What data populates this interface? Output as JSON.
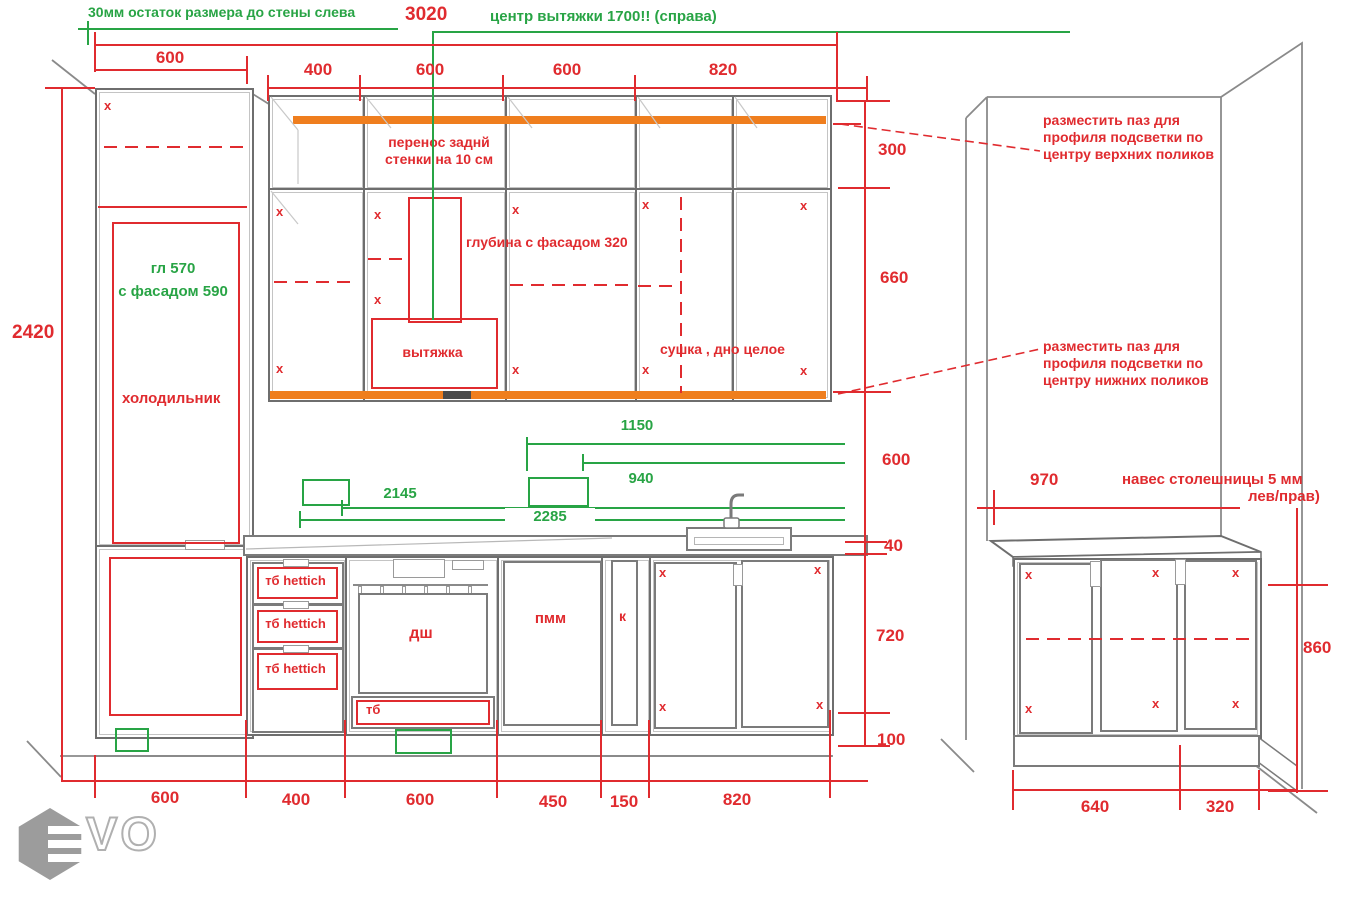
{
  "notes": {
    "left_wall_offset": "30мм остаток размера до стены слева",
    "hood_center": "центр вытяжки 1700!! (справа)",
    "back_panel": "перенос заднй стенки на 10 см",
    "depth_facade": "глубина с фасадом 320",
    "hood": "вытяжка",
    "dryer": "сушка , дно целое",
    "fridge_depth_1": "гл 570",
    "fridge_depth_2": "с фасадом 590",
    "fridge": "холодильник",
    "groove_upper": "разместить паз для профиля подсветки по центру верхних поликов",
    "groove_lower": "разместить паз для профиля подсветки по центру нижних поликов",
    "overhang_1": "навес столешницы 5 мм",
    "overhang_2": "лев/прав)"
  },
  "labels": {
    "drawer_hettich": "тб hettich",
    "drawer_tb": "тб",
    "oven": "дш",
    "dishwasher": "пмм",
    "cargo": "к",
    "x": "x"
  },
  "dims": {
    "d3020": "3020",
    "d2420": "2420",
    "d600": "600",
    "d400": "400",
    "d820": "820",
    "d300": "300",
    "d660": "660",
    "d1150": "1150",
    "d940": "940",
    "d2145": "2145",
    "d2285": "2285",
    "d40": "40",
    "d720": "720",
    "d100": "100",
    "d450": "450",
    "d150": "150",
    "d970": "970",
    "d640": "640",
    "d320": "320",
    "d860": "860"
  },
  "logo": {
    "text": "VO"
  },
  "colors": {
    "red": "#e02b2f",
    "green": "#28a445",
    "orange": "#ef7e1e",
    "line_gray": "#6e6e6e"
  }
}
